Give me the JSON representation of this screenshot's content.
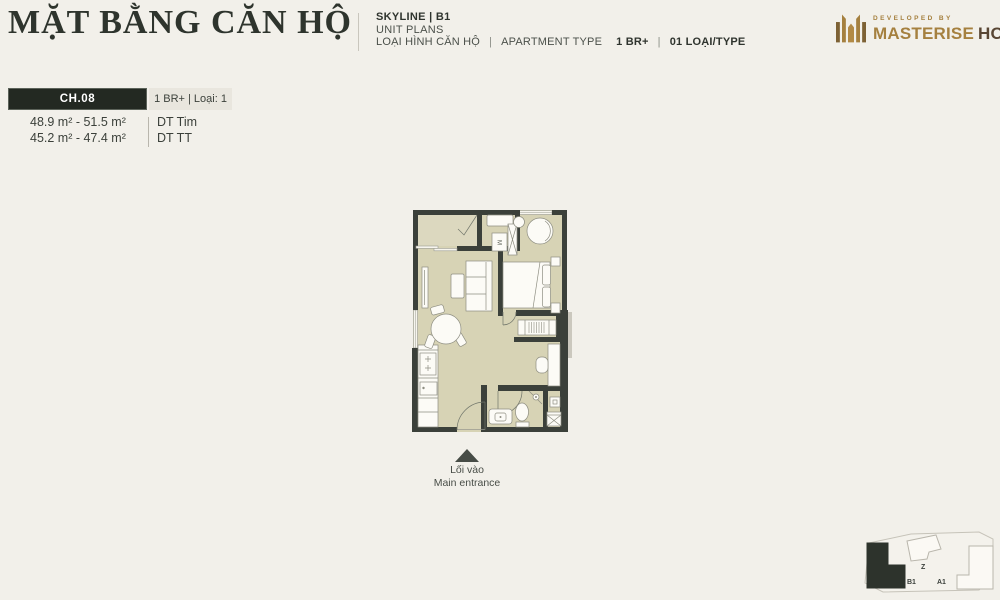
{
  "title": "MẶT BẰNG CĂN HỘ",
  "header": {
    "project": "SKYLINE | B1",
    "subtitle": "UNIT PLANS",
    "type_label_vi": "LOẠI HÌNH CĂN HỘ",
    "sep": "|",
    "type_label_en": "APARTMENT TYPE",
    "type_value": "1 BR+",
    "type_count": "01 LOẠI/TYPE"
  },
  "developer": {
    "tagline": "DEVELOPED BY",
    "name_primary": "MASTERISE",
    "name_secondary": "HOMES"
  },
  "unit": {
    "code": "CH.08",
    "type_badge": "1 BR+ | Loại: 1",
    "areas": [
      {
        "value": "48.9 m² - 51.5 m²",
        "label": "DT Tim"
      },
      {
        "value": "45.2 m² - 47.4 m²",
        "label": "DT TT"
      }
    ]
  },
  "floorplan": {
    "washer_label": "M",
    "entrance_vi": "Lối vào",
    "entrance_en": "Main entrance"
  },
  "keyplan": {
    "b1": "B1",
    "z": "Z",
    "a1": "A1"
  },
  "colors": {
    "background": "#f2f0ea",
    "accent_gold": "#a5803f",
    "brand_brown": "#594634",
    "wall": "#3b403a",
    "floor": "#d7d3b5",
    "badge_dark": "#232922"
  }
}
